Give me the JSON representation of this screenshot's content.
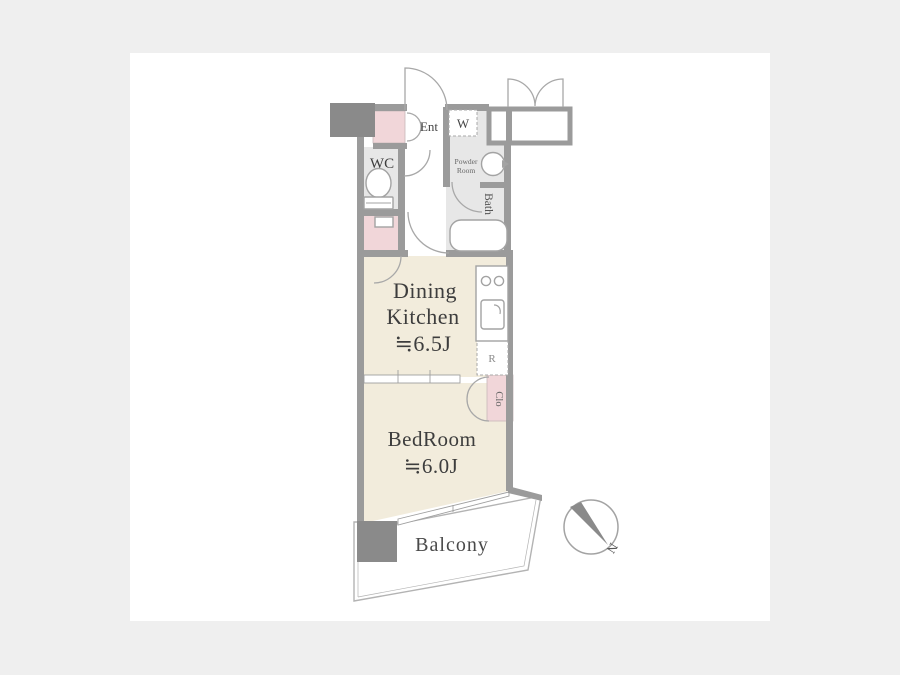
{
  "floorplan": {
    "entrance_label": "Ent",
    "washer_label": "W",
    "wc_label": "WC",
    "powder_room_line1": "Powder",
    "powder_room_line2": "Room",
    "bath_label": "Bath",
    "dining_kitchen_line1": "Dining",
    "dining_kitchen_line2": "Kitchen",
    "dining_kitchen_size": "≒6.5J",
    "refrigerator_label": "R",
    "closet_label": "Clo",
    "bedroom_line1": "BedRoom",
    "bedroom_size": "≒6.0J",
    "balcony_label": "Balcony",
    "compass_north_label": "N",
    "colors": {
      "page_background": "#efefef",
      "card_background": "#ffffff",
      "wall_gray": "#9b9b9b",
      "solid_gray": "#8a8a8a",
      "room_cream": "#f2ecdc",
      "accent_pink": "#f1d6d9",
      "wet_area_gray": "#e7e7e7",
      "text_dark": "#3d3d3d"
    }
  }
}
